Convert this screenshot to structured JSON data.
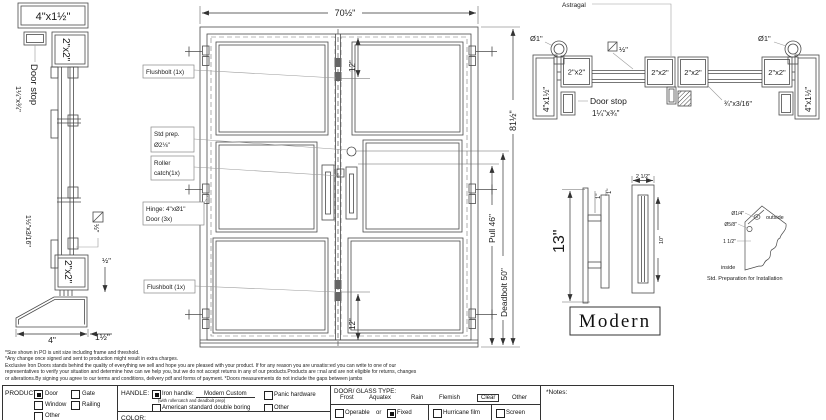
{
  "drawing": {
    "left_section": {
      "header": "4\"x1½\"",
      "door_stop": "Door stop",
      "door_stop_size": "1¼\"x¾\"",
      "rail_top": "2\"x2\"",
      "rail_bottom": "2\"x2\"",
      "glazing_bar": "1½\"x3/16\"",
      "square_half": "½\"",
      "gap_half": "½\"",
      "threshold_width": "4\"",
      "threshold_height": "1½\""
    },
    "elevation": {
      "dim_width": "70½\"",
      "dim_height": "81½\"",
      "dim_pull": "Pull 46\"",
      "dim_deadbolt": "Deadbolt 50\"",
      "dim_glass_top": "12\"",
      "dim_glass_bottom": "12\"",
      "flushbolt_top": "Flushbolt (1x)",
      "std_prep_1": "Std prep.",
      "std_prep_2": "Ø2⅛\"",
      "roller_1": "Roller",
      "roller_2": "catch(1x)",
      "hinge_1": "Hinge: 4\"xØ1\"",
      "hinge_2": "Door (3x)",
      "flushbolt_bottom": "Flushbolt (1x)"
    },
    "plan_section": {
      "astragal": "Astragal",
      "pin_left": "Ø1\"",
      "pin_right": "Ø1\"",
      "square_half": "½\"",
      "stile_1": "2\"x2\"",
      "stile_2": "2\"x2\"",
      "stile_3": "2\"x2\"",
      "stile_4": "2\"x2\"",
      "jamb_left": "4\"x1½\"",
      "jamb_right": "4\"x1½\"",
      "door_stop": "Door stop",
      "door_stop_size": "1¼\"x¾\"",
      "glazing_bar": "¾\"x3/16\""
    },
    "handle": {
      "dim_height": "13\"",
      "dim_proj": "1\"",
      "dim_width": "2 1/2\"",
      "dim_grip": "10\"",
      "style": "Modern"
    },
    "prep": {
      "dia_small": "Ø1/4\"",
      "dia_large": "Ø5/8\"",
      "offset": "1 1/2\"",
      "outside": "outside",
      "inside": "inside",
      "caption": "Std. Preparation for Installation"
    }
  },
  "disclaimer": {
    "line1": "*Size shown in PO is unit size including frame and threshold.",
    "line2": "*Any change once signed and sent to production might result in extra charges.",
    "line3": "Exclusive Iron Doors stands behind the quality of everything we sell and hope you are pleased with your product. If for any reason you are unsatis□ed you can write to one of our",
    "line4": "representatives to verify your situation and determine how can we help you, but we do not accept returns in any of our products.Products are □nal and are not eligible for returns, changes",
    "line5": "or alterations.By signing you agree to our terms and conditions, delivery pdf and forms of payment. *Doors measurements do not include the gaps between jambs"
  },
  "form": {
    "product": {
      "label": "PRODUCT:",
      "options": [
        {
          "label": "Door",
          "checked": true
        },
        {
          "label": "Gate",
          "checked": false
        },
        {
          "label": "Window",
          "checked": false
        },
        {
          "label": "Railing",
          "checked": false
        },
        {
          "label": "Other",
          "checked": false
        }
      ]
    },
    "handle": {
      "label": "HANDLE:",
      "iron_label": "Iron handle:",
      "iron_value": "Modern Custom",
      "iron_sub": "(with rollercatch and deadbolt prep)",
      "iron_checked": true,
      "american": "American standard double boring",
      "panic": "Panic hardware",
      "other": "Other"
    },
    "color_label": "COLOR:",
    "glass": {
      "label": "DOOR/ GLASS TYPE:",
      "types": [
        {
          "label": "Frost"
        },
        {
          "label": "Aquatex"
        },
        {
          "label": "Rain"
        },
        {
          "label": "Flemish"
        },
        {
          "label": "Clear"
        },
        {
          "label": "Other"
        }
      ],
      "selected_type": "Clear",
      "operable": "Operable",
      "or": "or",
      "fixed": "Fixed",
      "fixed_checked": true,
      "hurricane": "Hurricane film",
      "screen": "Screen"
    },
    "notes_label": "*Notes:"
  }
}
